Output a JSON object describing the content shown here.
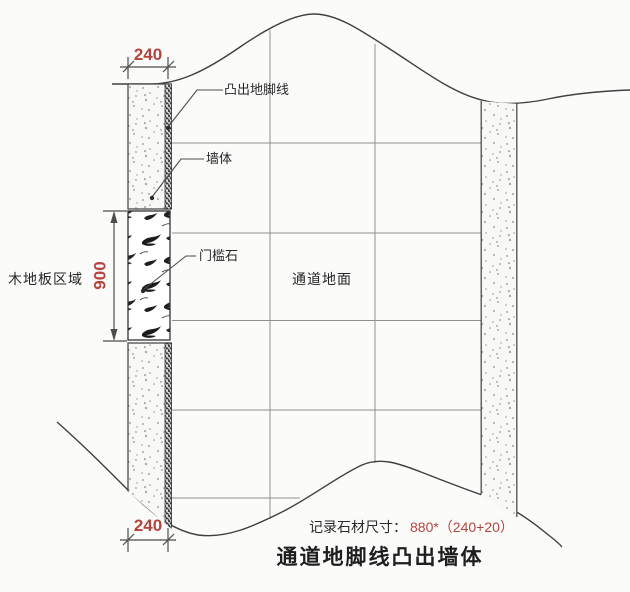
{
  "drawing": {
    "title": "通道地脚线凸出墙体",
    "note": {
      "label": "记录石材尺寸：",
      "value": "880*（240+20）"
    },
    "labels": {
      "protruding_skirting": "凸出地脚线",
      "wall": "墙体",
      "threshold_stone": "门槛石",
      "corridor_floor": "通道地面",
      "wood_floor_area": "木地板区域"
    },
    "dimensions": {
      "top_width": "240",
      "bottom_width": "240",
      "threshold_height": "900"
    },
    "colors": {
      "dimension_red": "#b5443f",
      "line_dark": "#4c4c4c",
      "grid_gray": "#8f8f8f"
    }
  }
}
